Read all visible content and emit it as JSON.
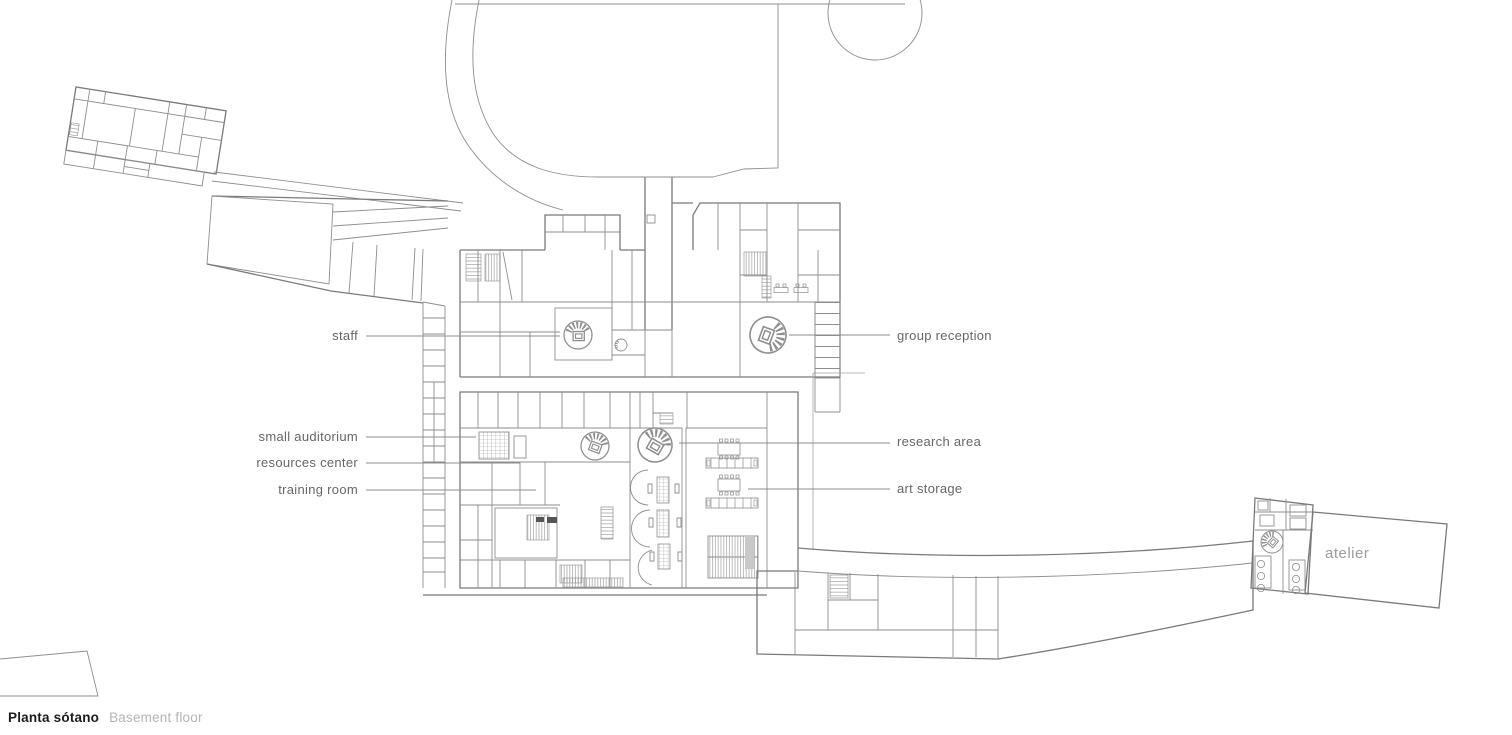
{
  "drawing": {
    "type": "architectural floor plan",
    "caption": {
      "title_es": "Planta sótano",
      "title_en": "Basement floor"
    },
    "room_labels": {
      "staff": "staff",
      "group_reception": "group reception",
      "small_auditorium": "small auditorium",
      "resources_center": "resources center",
      "training_room": "training room",
      "research_area": "research area",
      "art_storage": "art storage",
      "atelier": "atelier"
    },
    "colors": {
      "background": "#ffffff",
      "plan_line": "#8e8e8e",
      "label_text": "#666666",
      "atelier_label": "#9c9c9c",
      "caption_title": "#1c1c1c",
      "caption_subtitle": "#b5b5b5",
      "gray_fill": "#c9c9c9",
      "dark_fill": "#555555"
    }
  }
}
